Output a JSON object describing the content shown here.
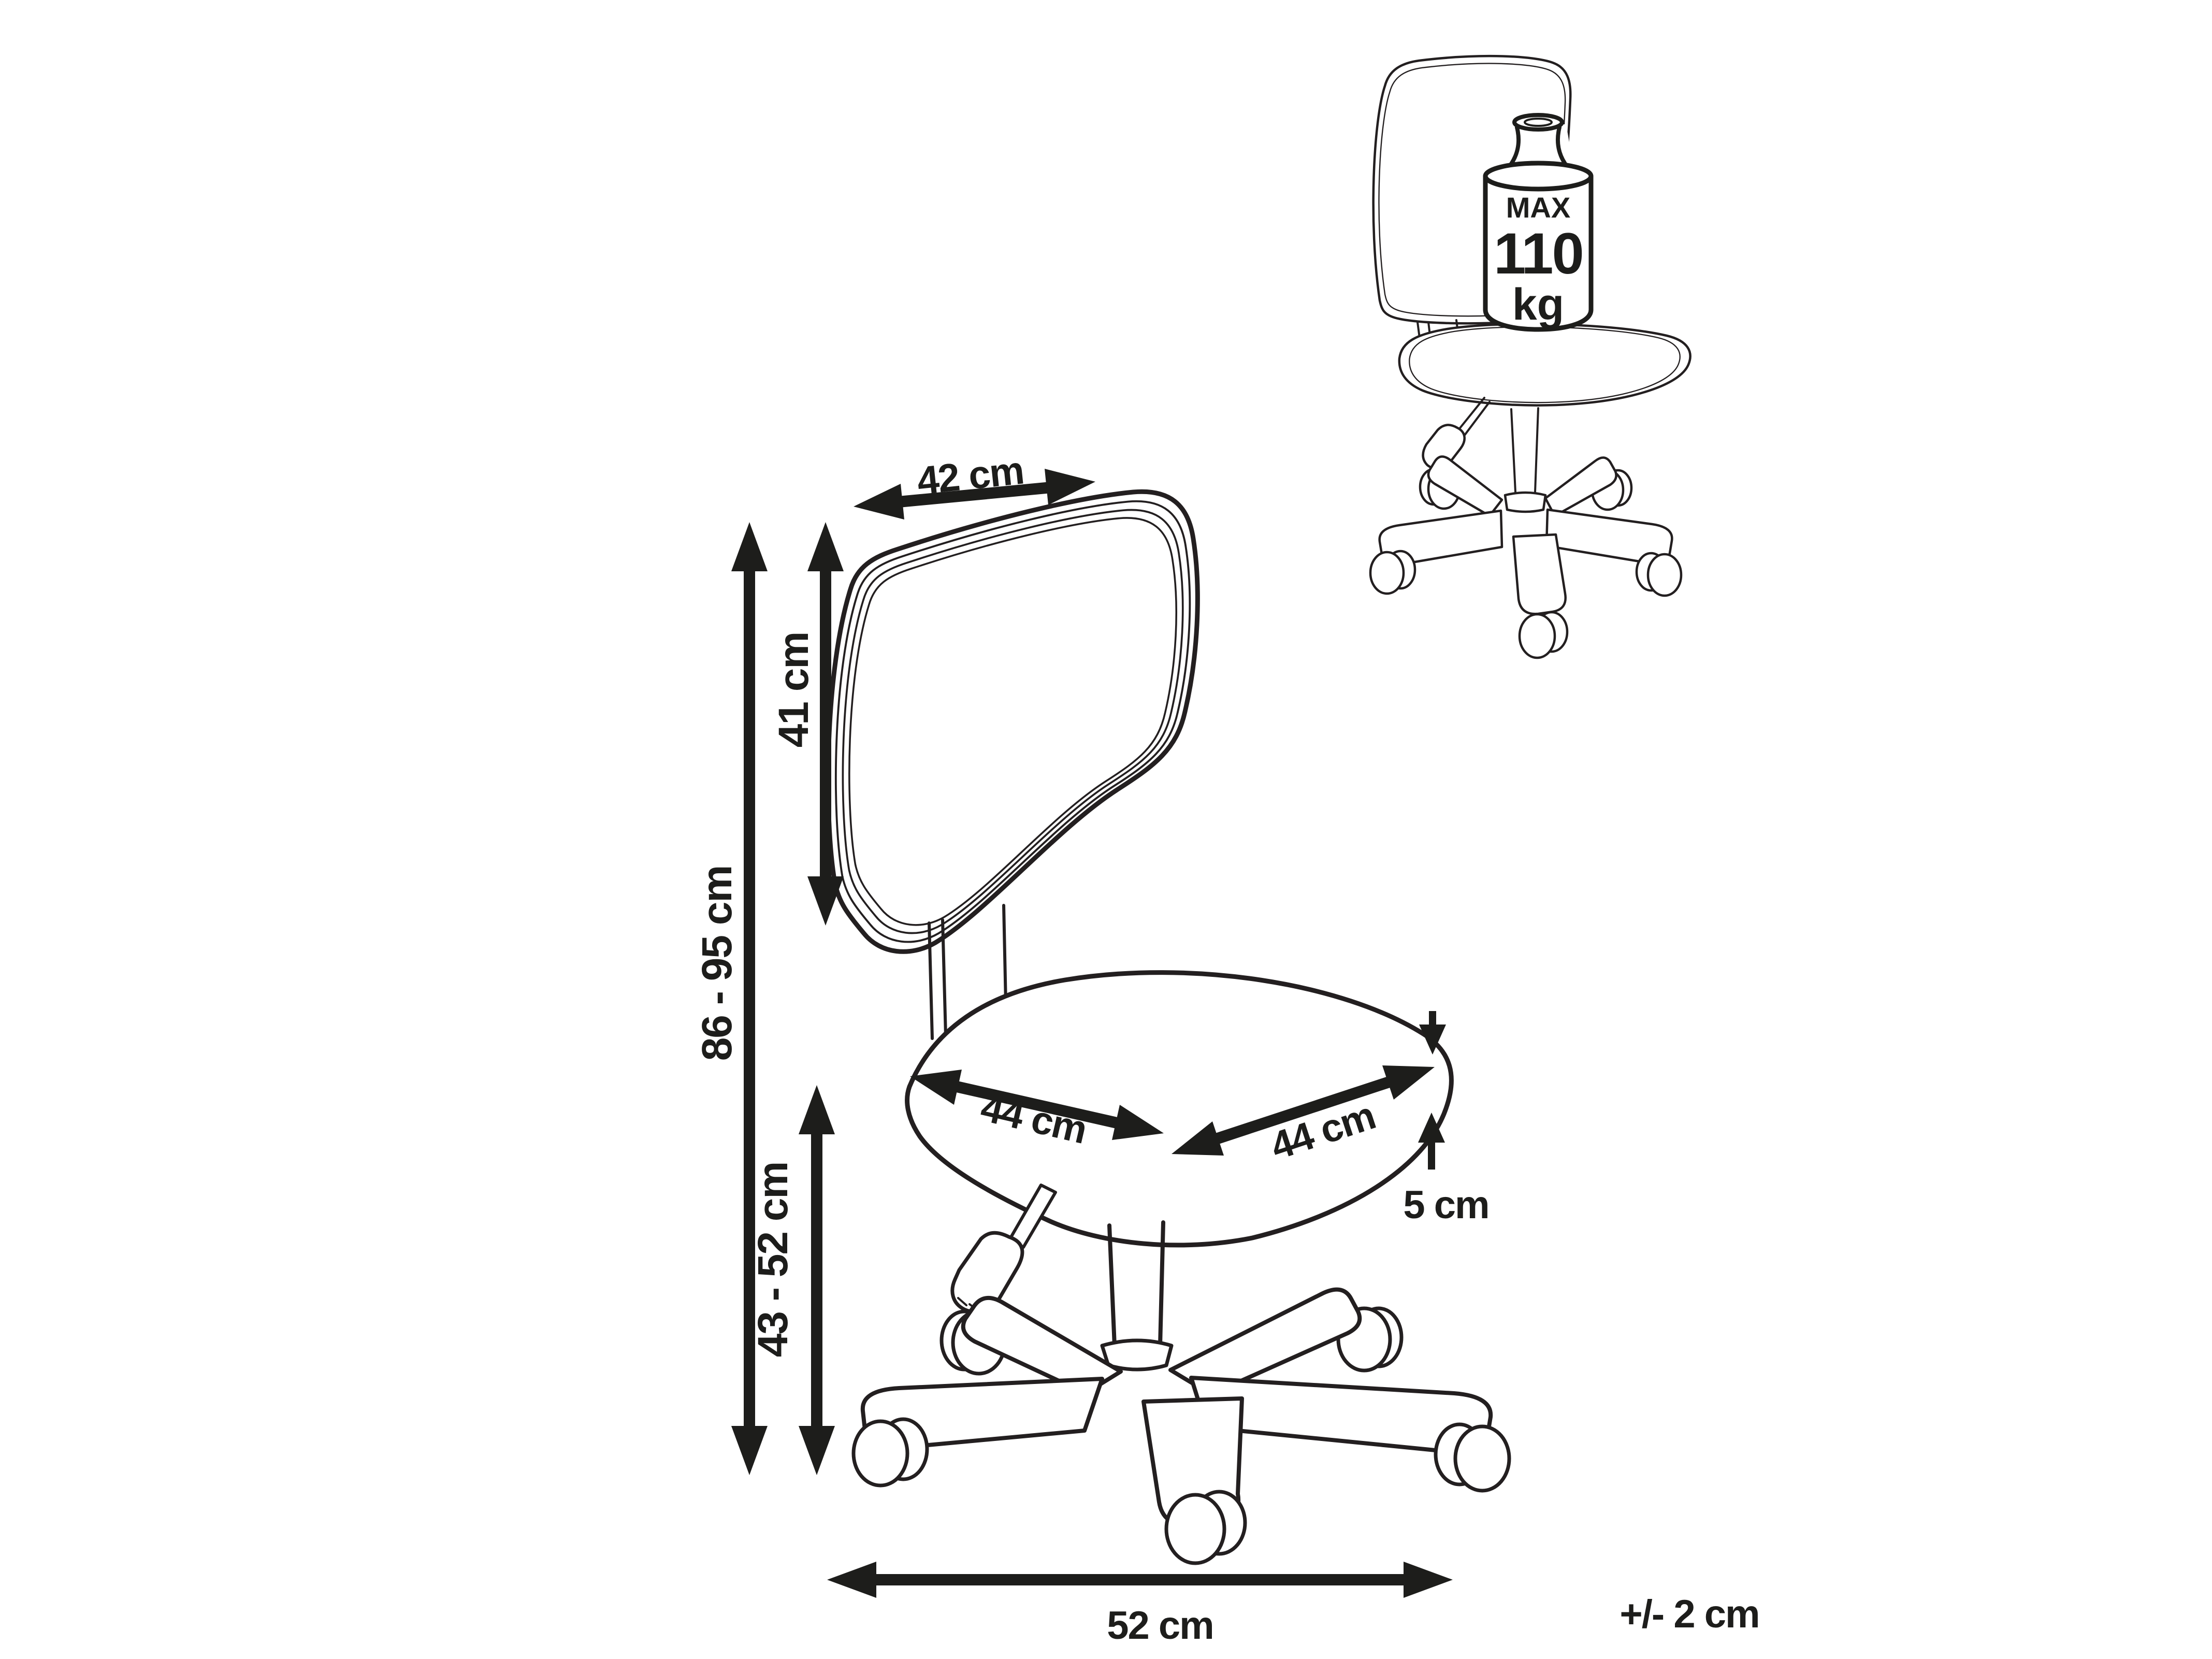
{
  "figure": {
    "kind": "chair-dimension-line-drawing",
    "background": "#ffffff",
    "line_color": "#231f20",
    "dims": {
      "backrest_width": "42 cm",
      "backrest_height": "41 cm",
      "total_height": "86 - 95 cm",
      "seat_height": "43 - 52 cm",
      "seat_width": "44 cm",
      "seat_depth": "44 cm",
      "seat_thickness": "5 cm",
      "base_width": "52 cm",
      "tolerance": "+/- 2 cm"
    },
    "max_load": {
      "line1": "MAX",
      "line2": "110",
      "line3": "kg"
    }
  }
}
